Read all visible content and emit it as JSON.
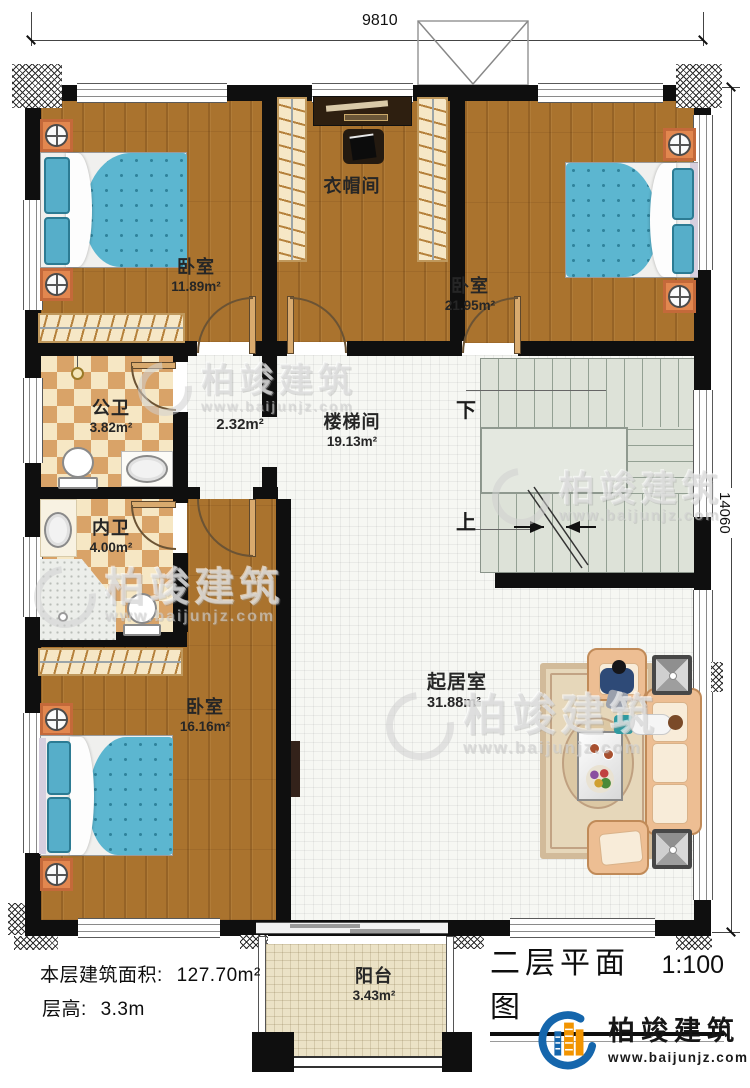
{
  "plan": {
    "dimensions": {
      "top_width": "9810",
      "right_height": "14060"
    },
    "rooms": [
      {
        "name": "卧室",
        "area": "11.89m²"
      },
      {
        "name": "衣帽间",
        "area": ""
      },
      {
        "name": "卧室",
        "area": "21.95m²"
      },
      {
        "name": "公卫",
        "area": "3.82m²"
      },
      {
        "name": "",
        "area": "2.32m²"
      },
      {
        "name": "内卫",
        "area": "4.00m²"
      },
      {
        "name": "楼梯间",
        "area": "19.13m²"
      },
      {
        "name": "卧室",
        "area": "16.16m²"
      },
      {
        "name": "起居室",
        "area": "31.88m²"
      },
      {
        "name": "阳台",
        "area": "3.43m²"
      }
    ],
    "stairs": {
      "down_label": "下",
      "up_label": "上"
    }
  },
  "footer": {
    "area_label": "本层建筑面积:",
    "area_value": "127.70m²",
    "height_label": "层高:",
    "height_value": "3.3m"
  },
  "title_block": {
    "title": "二层平面图",
    "scale": "1:100"
  },
  "brand": {
    "name": "柏竣建筑",
    "website": "www.baijunjz.com"
  },
  "watermark": {
    "name": "柏竣建筑",
    "website": "www.baijunjz.com"
  },
  "colors": {
    "wall": "#0f0f0f",
    "wood_floor": "#aa732e",
    "tile_floor": "#f6f7f3",
    "checker_tan": "#d9a368",
    "stair_grey": "#dde2d8",
    "quilt_blue": "#5cb6d0",
    "nightstand_orange": "#e2874f",
    "brand_blue": "#1566ac",
    "brand_orange": "#f29400"
  }
}
